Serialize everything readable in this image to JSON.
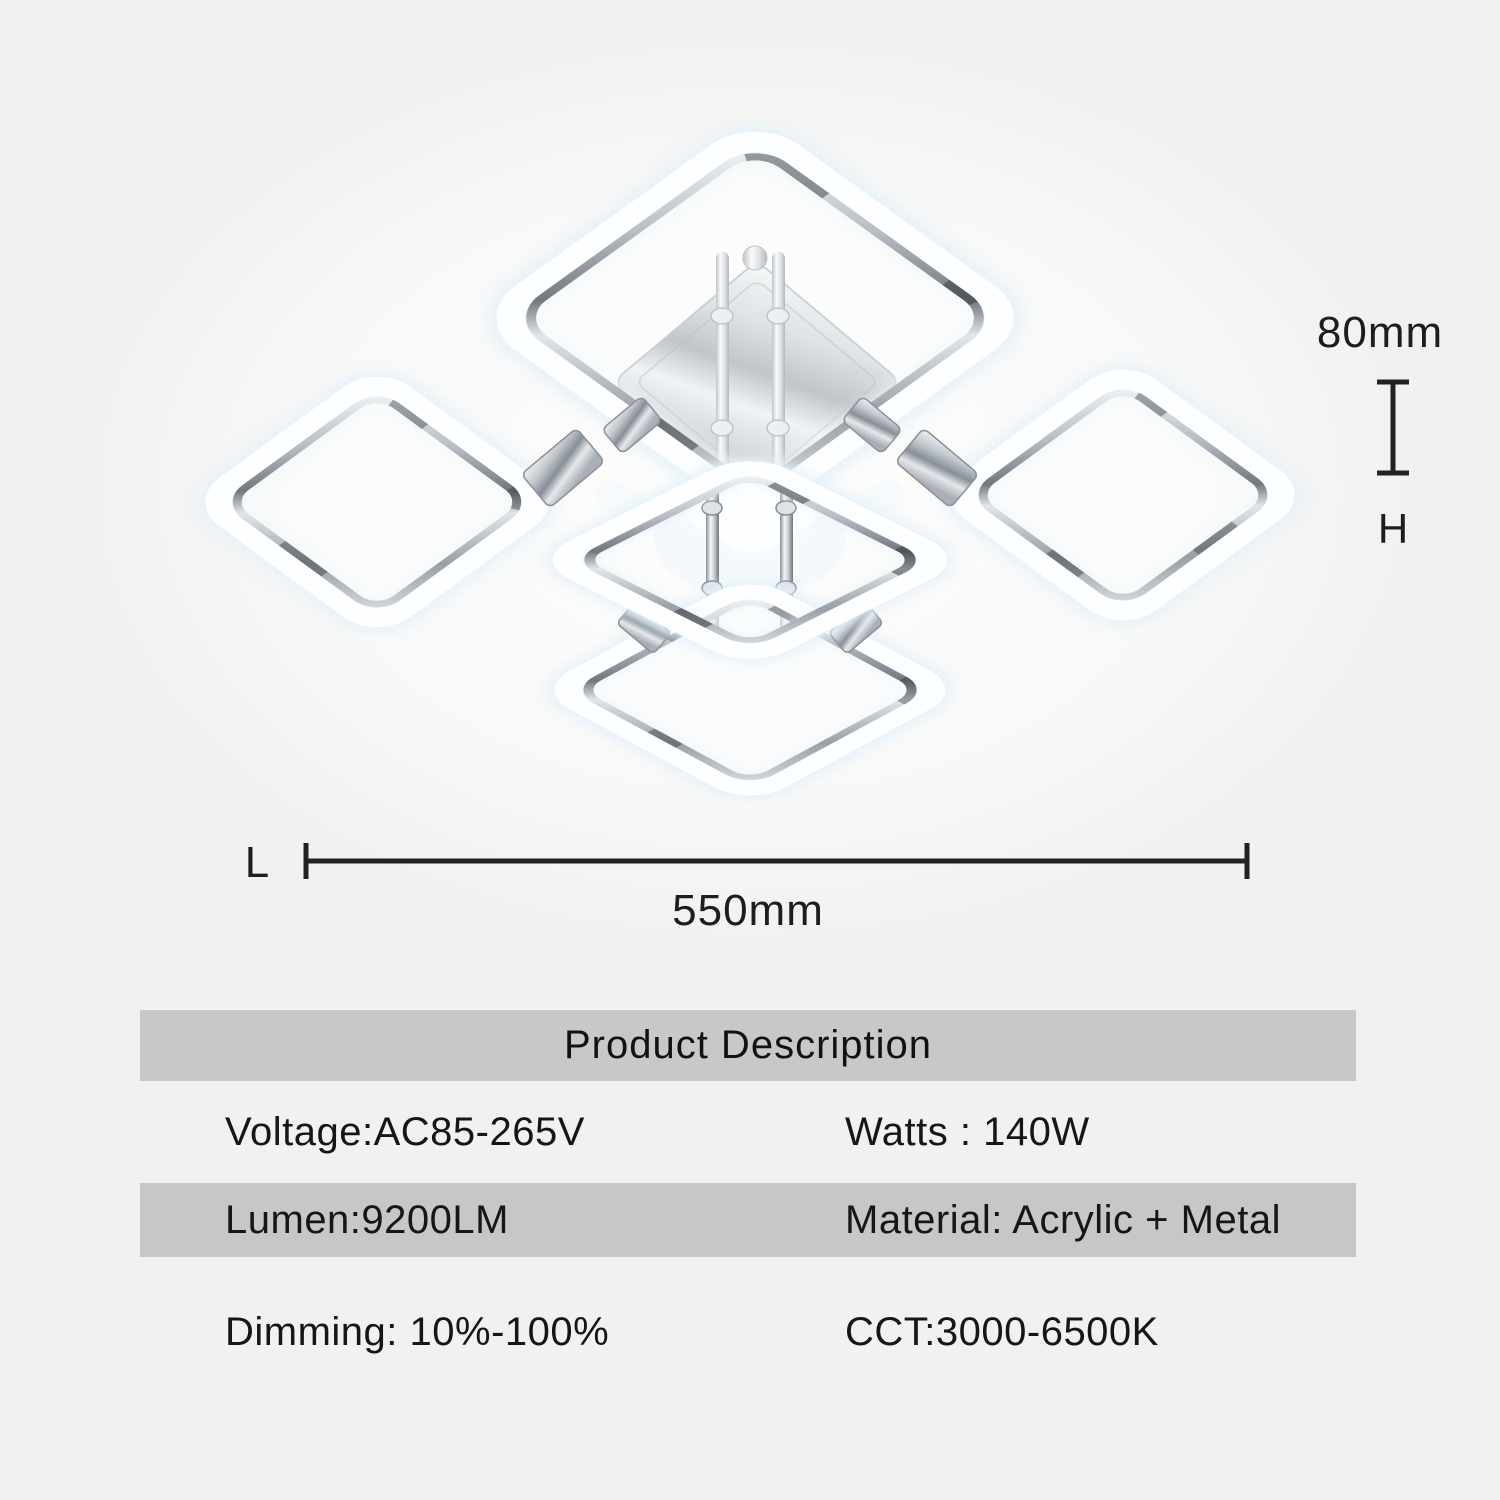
{
  "image": {
    "alt": "Chrome LED ceiling lamp with five glowing rounded-square rings on a chrome canopy"
  },
  "dimensions": {
    "height_value": "80mm",
    "height_axis_label": "H",
    "length_axis_label": "L",
    "length_value": "550mm"
  },
  "table": {
    "title": "Product Description",
    "rows": [
      {
        "left": "Voltage:AC85-265V",
        "right": "Watts : 140W"
      },
      {
        "left": "Lumen:9200LM",
        "right": "Material: Acrylic + Metal"
      },
      {
        "left": "Dimming: 10%-100%",
        "right": "CCT:3000-6500K"
      }
    ]
  },
  "colors": {
    "background": "#f1f1ef",
    "band_gray": "#c7c8c8",
    "text": "#161616",
    "glow": "#e3f1fa",
    "dimension_line": "#222222"
  }
}
